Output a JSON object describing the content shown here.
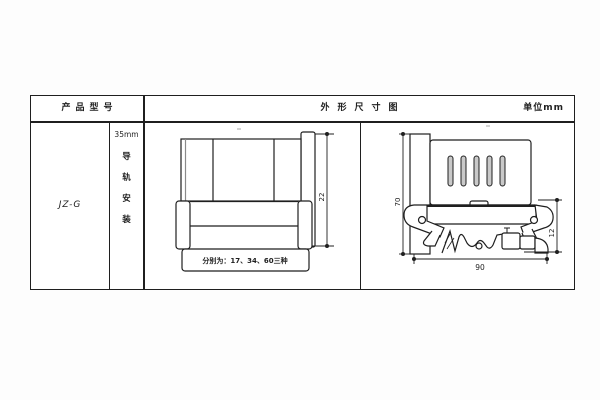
{
  "header": {
    "product_model": "产品型号",
    "outline_title": "外形尺寸图",
    "unit": "单位mm"
  },
  "model_cell": {
    "model": "JZ-G"
  },
  "mount_cell": {
    "top": "35mm",
    "chars": [
      "导",
      "轨",
      "安",
      "装"
    ]
  },
  "front_view": {
    "height_dim": "22",
    "note": "分别为：17、34、60三种"
  },
  "side_view": {
    "height_dim": "70",
    "right_dim": "12",
    "width_dim": "90"
  },
  "colors": {
    "line": "#1f1f1f",
    "background": "#fdfdfd",
    "slot_fill": "#c9c9c9",
    "shadow_gray": "#8a8a8a"
  }
}
